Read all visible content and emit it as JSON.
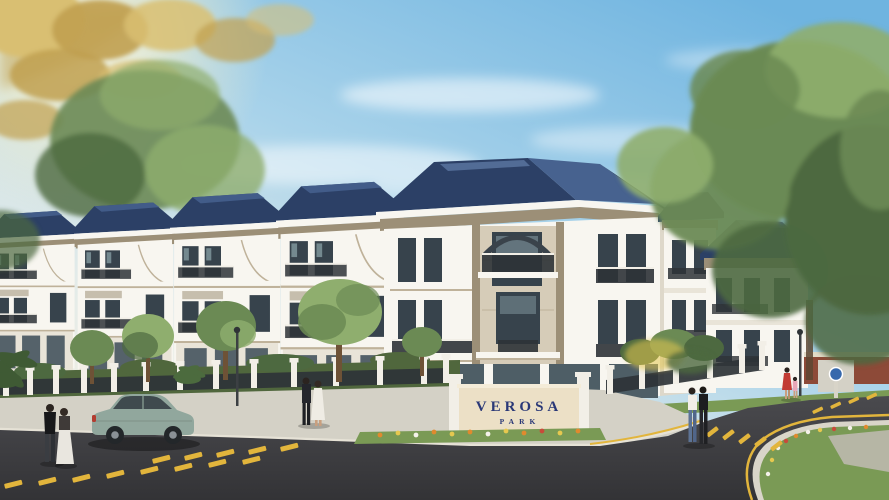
{
  "image": {
    "kind": "architectural-rendering",
    "title": "Verosa Park residential villas — street corner exterior rendering",
    "development_name": "Verosa Park",
    "sign": {
      "line1": "VEROSA",
      "line2": "PARK"
    },
    "scene_elements": [
      "blue sky with wispy clouds and sun glare",
      "sun-lit golden foliage upper left",
      "row of three-storey townhouse villas with navy hip roofs",
      "large corner villa with stone-clad tower and iron balconies",
      "entrance name wall with flower bed",
      "white fence pillars with dark iron panels and hedges",
      "street trees and shrubs",
      "asphalt road with yellow lane dashes and curb lines",
      "landscaped corner island with flowers",
      "parked sage-green sedan",
      "pedestrian couples crossing and walking",
      "woman in red with child in pink",
      "street lamp posts",
      "brick garden walls with round blue traffic sign"
    ],
    "colors": {
      "sky_top": "#6fb4e0",
      "sky_mid": "#c7e2ef",
      "sky_low": "#f4efe2",
      "sun": "#fff3c9",
      "gold_leaf": "#d9bf72",
      "gold_leaf2": "#c0a050",
      "leaf": "#6b8a54",
      "leaf_dark": "#4d6940",
      "leaf_light": "#8fae6e",
      "roof": "#2c4066",
      "roof_light": "#47628f",
      "roof_dark": "#223252",
      "facade": "#f8f6f0",
      "facade_shade": "#e9e4d8",
      "side_shade": "#ded8ca",
      "cornice": "#9c8f77",
      "stone": "#d6ccb8",
      "stone_dark": "#bfb29a",
      "win": "#37434c",
      "glass": "#8fa6ad",
      "rail": "#2e3337",
      "hedge": "#50673d",
      "grass": "#7a9a55",
      "walk": "#d4d1c6",
      "walk_dark": "#bcb9ae",
      "curb": "#e6e2d6",
      "road_hi": "#4a4a4e",
      "road_lo": "#333336",
      "yellow": "#e2b53c",
      "sign_wall": "#ece0c6",
      "sign_navy": "#2a3877",
      "fence_pillar": "#f2efe7",
      "car": "#91a79d",
      "car_glass": "#3f4a4e",
      "brick": "#8d4a38",
      "skin": "#c99f7e"
    }
  }
}
